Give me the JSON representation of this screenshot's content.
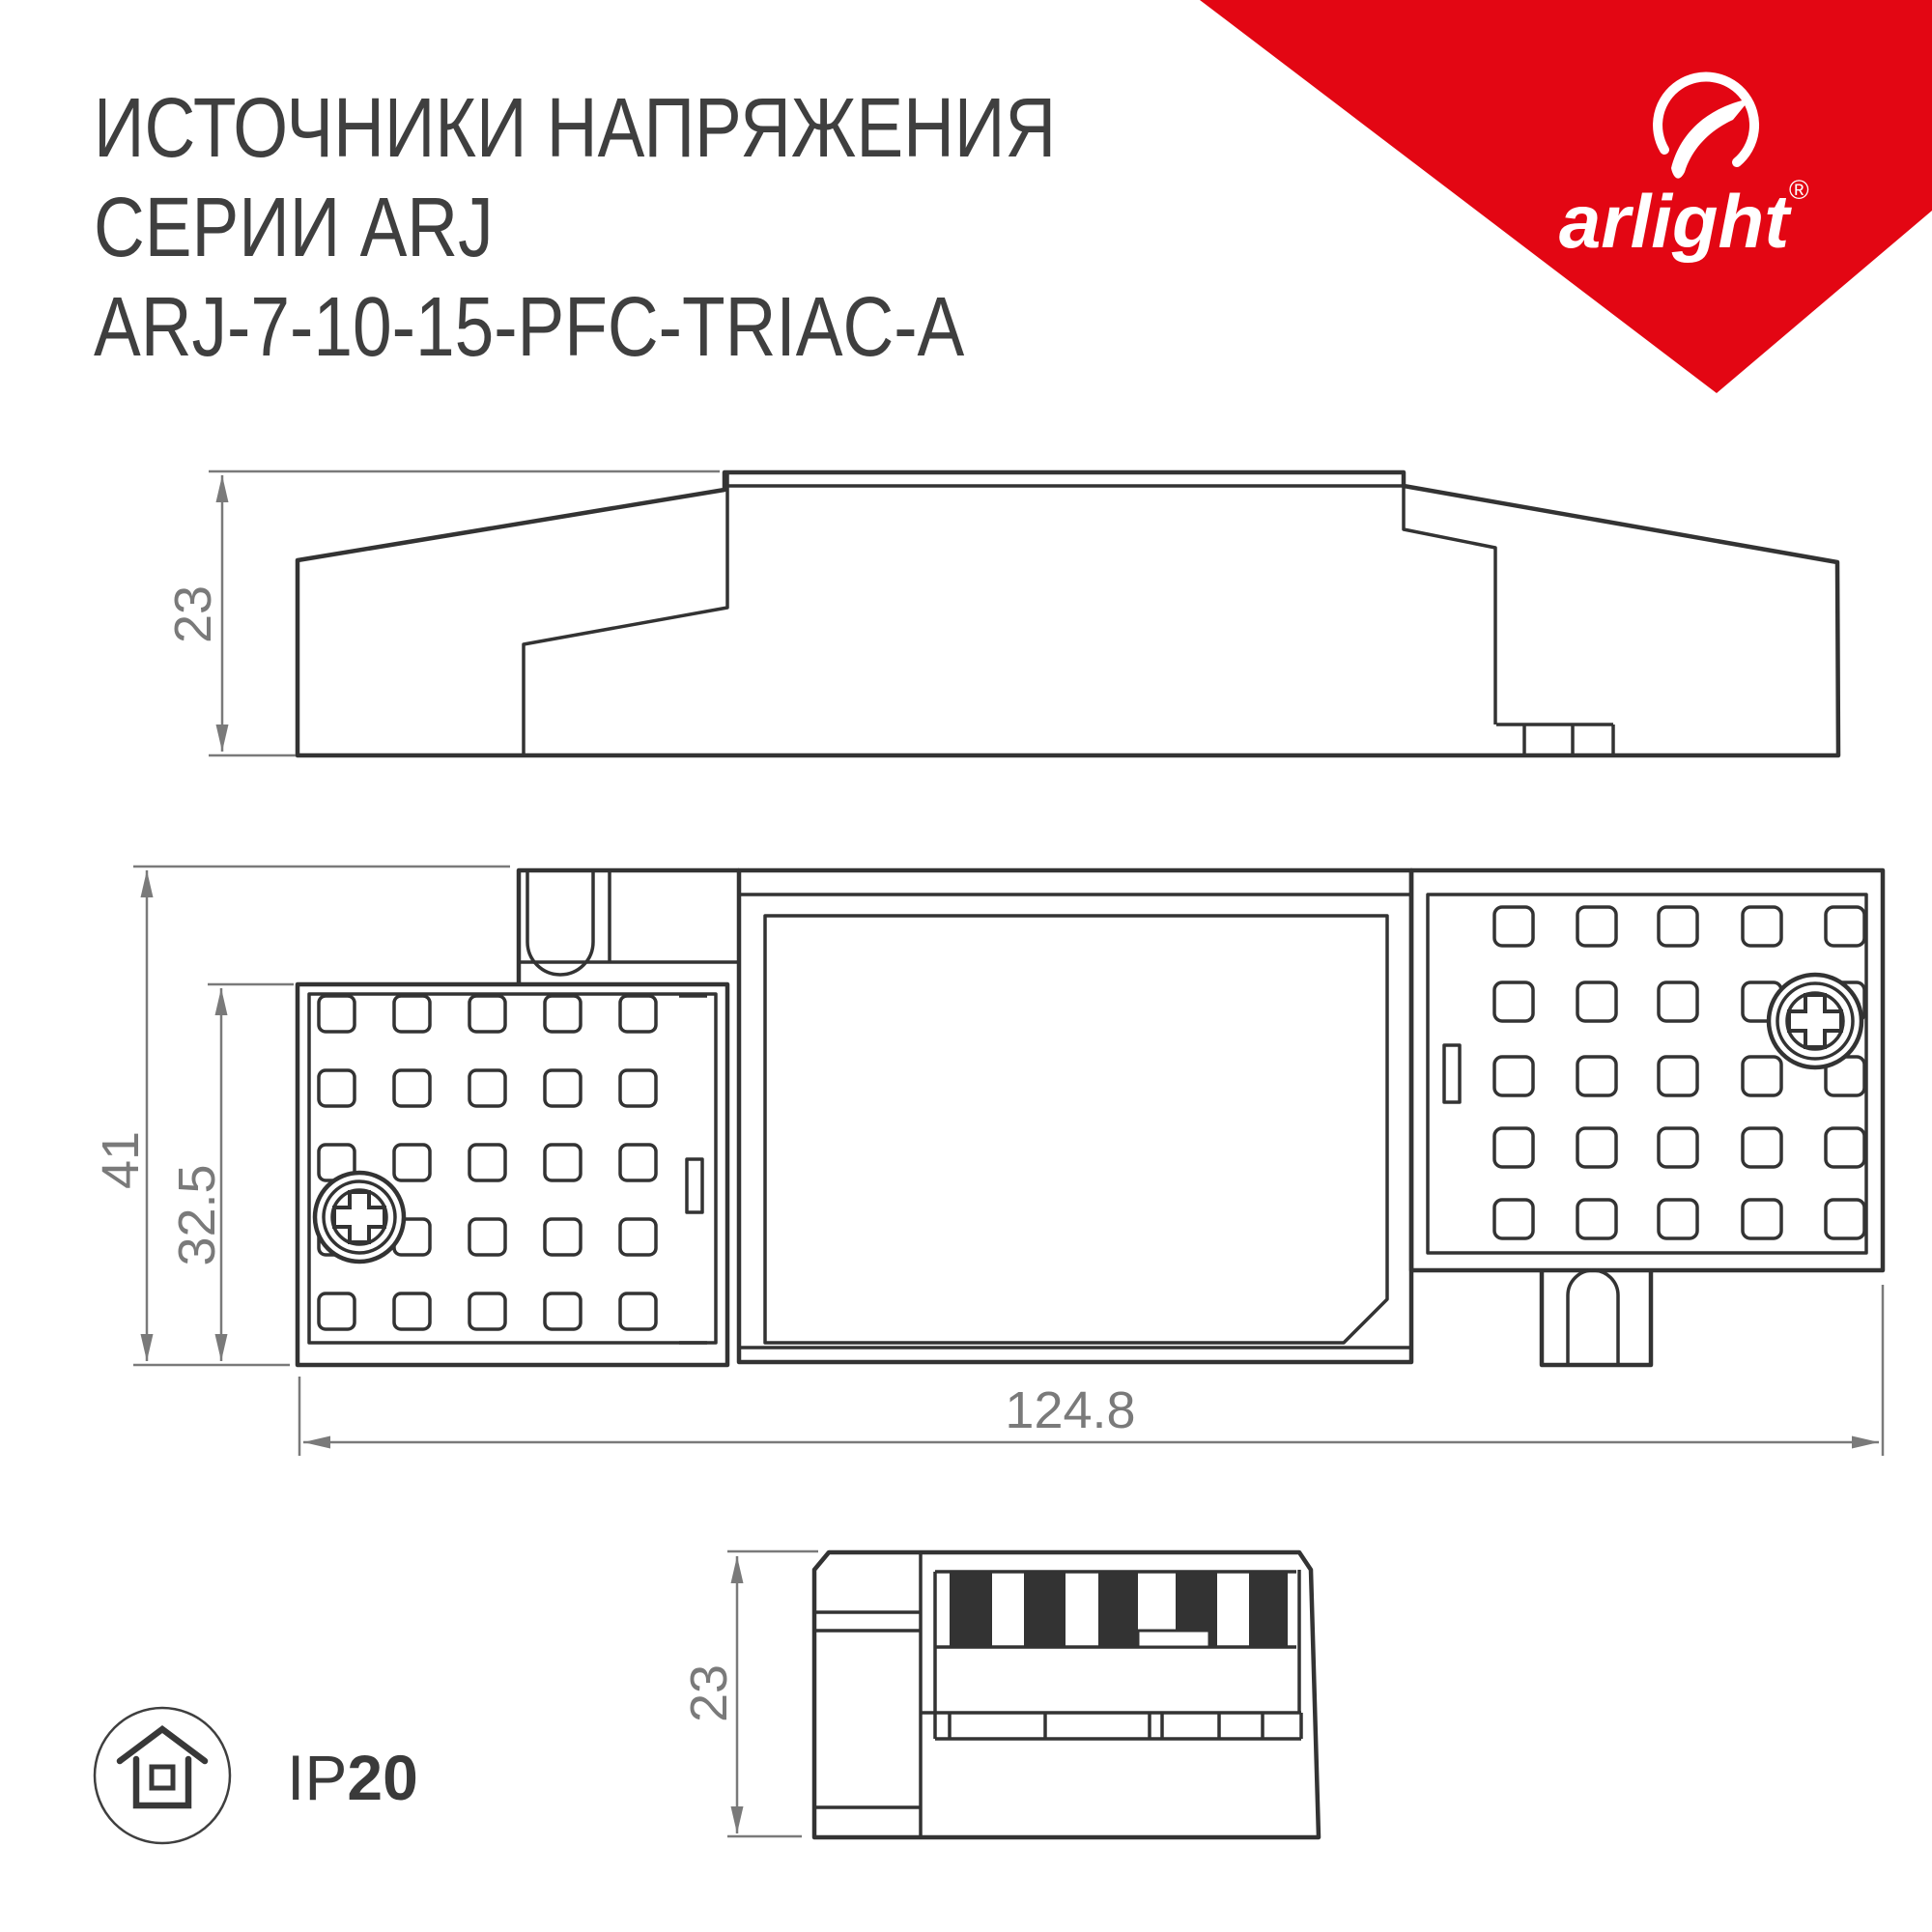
{
  "header": {
    "line1": "ИСТОЧНИКИ НАПРЯЖЕНИЯ",
    "line2": "СЕРИИ ARJ",
    "line3": "ARJ-7-10-15-PFC-TRIAC-A"
  },
  "logo": {
    "brand": "arlight",
    "registered": "®",
    "accent_red": "#E30613"
  },
  "colors": {
    "line": "#333333",
    "dimension": "#7A7A7A",
    "title_text": "#3F3F3F",
    "stripe_fill": "#333333",
    "background": "#FFFFFF"
  },
  "dims": {
    "side_height": "23",
    "total_width": "41",
    "body_width": "32.5",
    "length": "124.8",
    "end_height": "23"
  },
  "ip": {
    "prefix": "IP",
    "value": "20"
  }
}
